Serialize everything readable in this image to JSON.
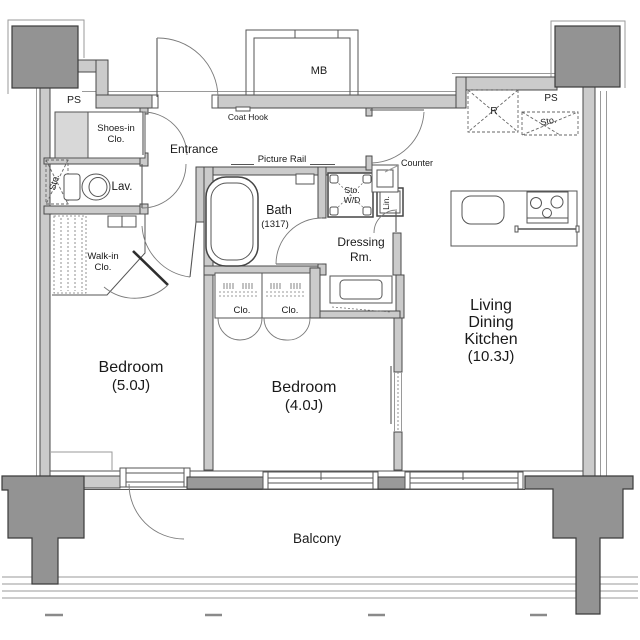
{
  "title": "Apartment floor plan 2LDK",
  "colors": {
    "background": "#ffffff",
    "wall_fill": "#cbcbcb",
    "column_fill": "#939393",
    "outline": "#4a4a4a",
    "text": "#1a1a1a"
  },
  "labels": {
    "ps_left": "PS",
    "ps_right": "PS",
    "mb": "MB",
    "coat_hook": "Coat Hook",
    "shoes_closet_line1": "Shoes-in",
    "shoes_closet_line2": "Clo.",
    "entrance": "Entrance",
    "picture_rail": "Picture Rail",
    "storage_hall": "Sto.",
    "lavatory": "Lav.",
    "walk_in_closet_line1": "Walk-in",
    "walk_in_closet_line2": "Clo.",
    "bath_line1": "Bath",
    "bath_line2": "(1317)",
    "storage_wd_line1": "Sto.",
    "storage_wd_line2": "W/D",
    "linen": "Lin.",
    "dressing_line1": "Dressing",
    "dressing_line2": "Rm.",
    "counter": "Counter",
    "refrigerator": "R",
    "storage_kitchen": "Sto.",
    "closet_left": "Clo.",
    "closet_right": "Clo.",
    "bedroom_5_line1": "Bedroom",
    "bedroom_5_line2": "(5.0J)",
    "bedroom_4_line1": "Bedroom",
    "bedroom_4_line2": "(4.0J)",
    "ldk_line1": "Living",
    "ldk_line2": "Dining",
    "ldk_line3": "Kitchen",
    "ldk_line4": "(10.3J)",
    "balcony": "Balcony"
  }
}
